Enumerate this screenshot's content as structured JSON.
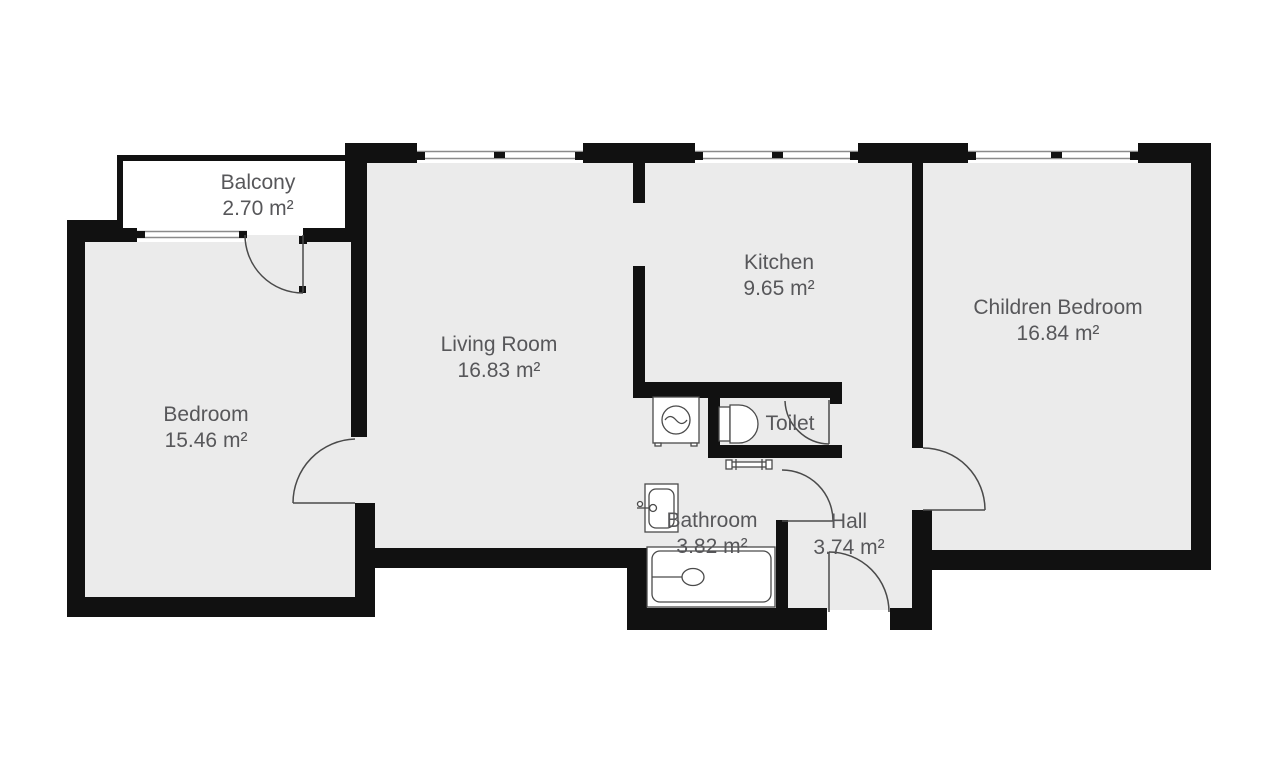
{
  "plan": {
    "type": "apartment-floor-plan",
    "colors": {
      "wall": "#111111",
      "floor": "#ebebeb",
      "balcony_floor": "#ffffff",
      "background": "#ffffff",
      "fixture_outline": "#4a4a4a",
      "label_text": "#57575a"
    },
    "rooms": {
      "balcony": {
        "name": "Balcony",
        "area": "2.70 m²"
      },
      "bedroom": {
        "name": "Bedroom",
        "area": "15.46 m²"
      },
      "living_room": {
        "name": "Living Room",
        "area": "16.83 m²"
      },
      "kitchen": {
        "name": "Kitchen",
        "area": "9.65 m²"
      },
      "children_bedroom": {
        "name": "Children Bedroom",
        "area": "16.84 m²"
      },
      "toilet": {
        "name": "Toilet"
      },
      "bathroom": {
        "name": "Bathroom",
        "area": "3.82 m²"
      },
      "hall": {
        "name": "Hall",
        "area": "3.74 m²"
      }
    },
    "fixtures": [
      "washing-machine-icon",
      "toilet-bowl-icon",
      "radiator-icon",
      "sink-icon",
      "bathtub-icon"
    ],
    "openings": {
      "windows": [
        "bedroom-balcony-window",
        "living-room-window",
        "kitchen-window",
        "children-bedroom-window"
      ],
      "doors": [
        "balcony-door",
        "bedroom-door",
        "toilet-door",
        "bathroom-door",
        "children-bedroom-door",
        "entrance-door"
      ]
    }
  }
}
